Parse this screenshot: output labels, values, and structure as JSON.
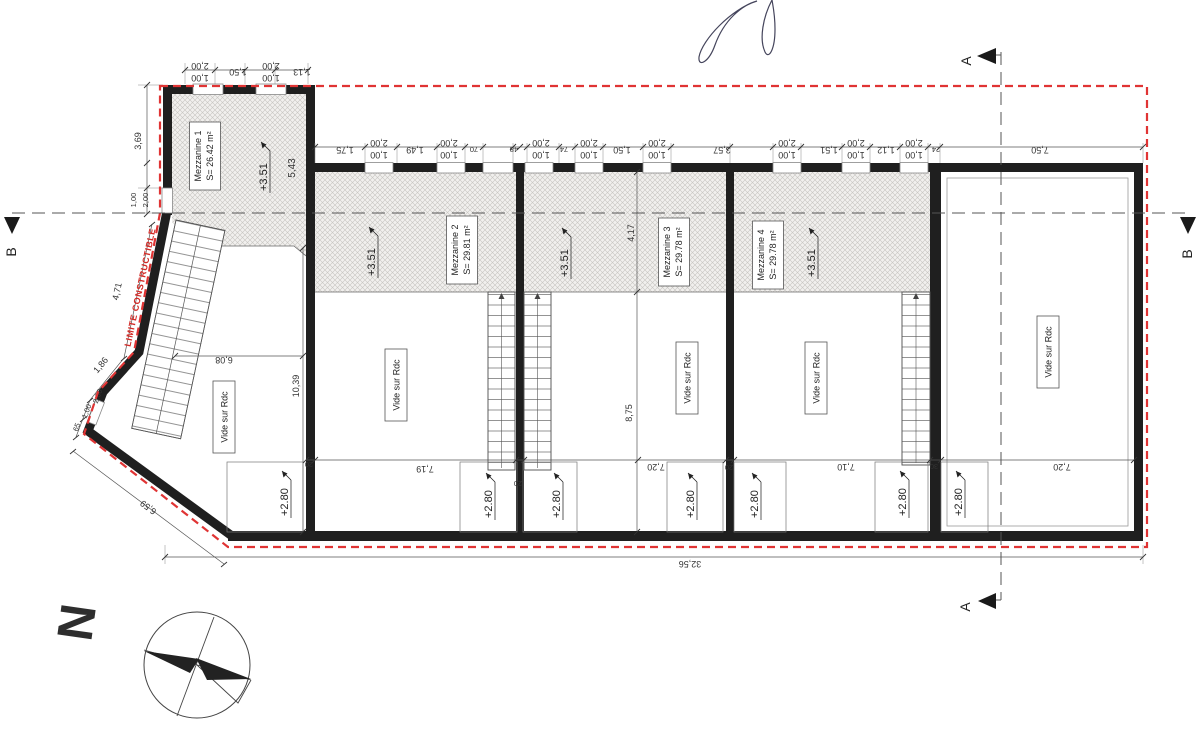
{
  "drawing": {
    "boundary_label": "LIMITE CONSTRUCTIBLE",
    "north_label": "N",
    "section_a": "A",
    "section_b": "B",
    "void_label": "Vide sur Rdc",
    "levels": {
      "mezzanine": "+3.51",
      "lower": "+2.80"
    },
    "mezzanines": [
      {
        "name": "Mezzanine 1",
        "area": "S= 26.42 m²"
      },
      {
        "name": "Mezzanine 2",
        "area": "S= 29.81 m²"
      },
      {
        "name": "Mezzanine 3",
        "area": "S= 29.78 m²"
      },
      {
        "name": "Mezzanine 4",
        "area": "S= 29.78 m²"
      }
    ],
    "colors": {
      "boundary_red": "#e03434",
      "wall_black": "#1f1f1f"
    },
    "dims": {
      "mezz1_top": [
        "2,00",
        "1,00",
        "1,50",
        "2,00",
        "1,00",
        "1,13"
      ],
      "main_top": [
        "1,75",
        "2,00",
        "1,00",
        "1,49",
        "2,00",
        "1,00",
        "70",
        "48",
        "2,00",
        "1,00",
        "74",
        "2,00",
        "1,00",
        "1,50",
        "2,00",
        "1,00",
        "3,57",
        "2,00",
        "1,00",
        "1,51",
        "2,00",
        "1,00",
        "1,12",
        "2,00",
        "1,00",
        "24",
        "7,50"
      ],
      "left": [
        "3,69",
        "1,00",
        "2,00"
      ],
      "diagonal": [
        "4,71",
        "1,86",
        "2,00",
        "1,00",
        "65",
        "6,59"
      ],
      "interior": [
        "6,08",
        "10,39",
        "5,43",
        "4,17",
        "8,75",
        "32,56"
      ],
      "bottom": [
        "7,19",
        "20",
        "20",
        "7,20",
        "20",
        "7,10",
        "30",
        "7,20"
      ]
    }
  }
}
